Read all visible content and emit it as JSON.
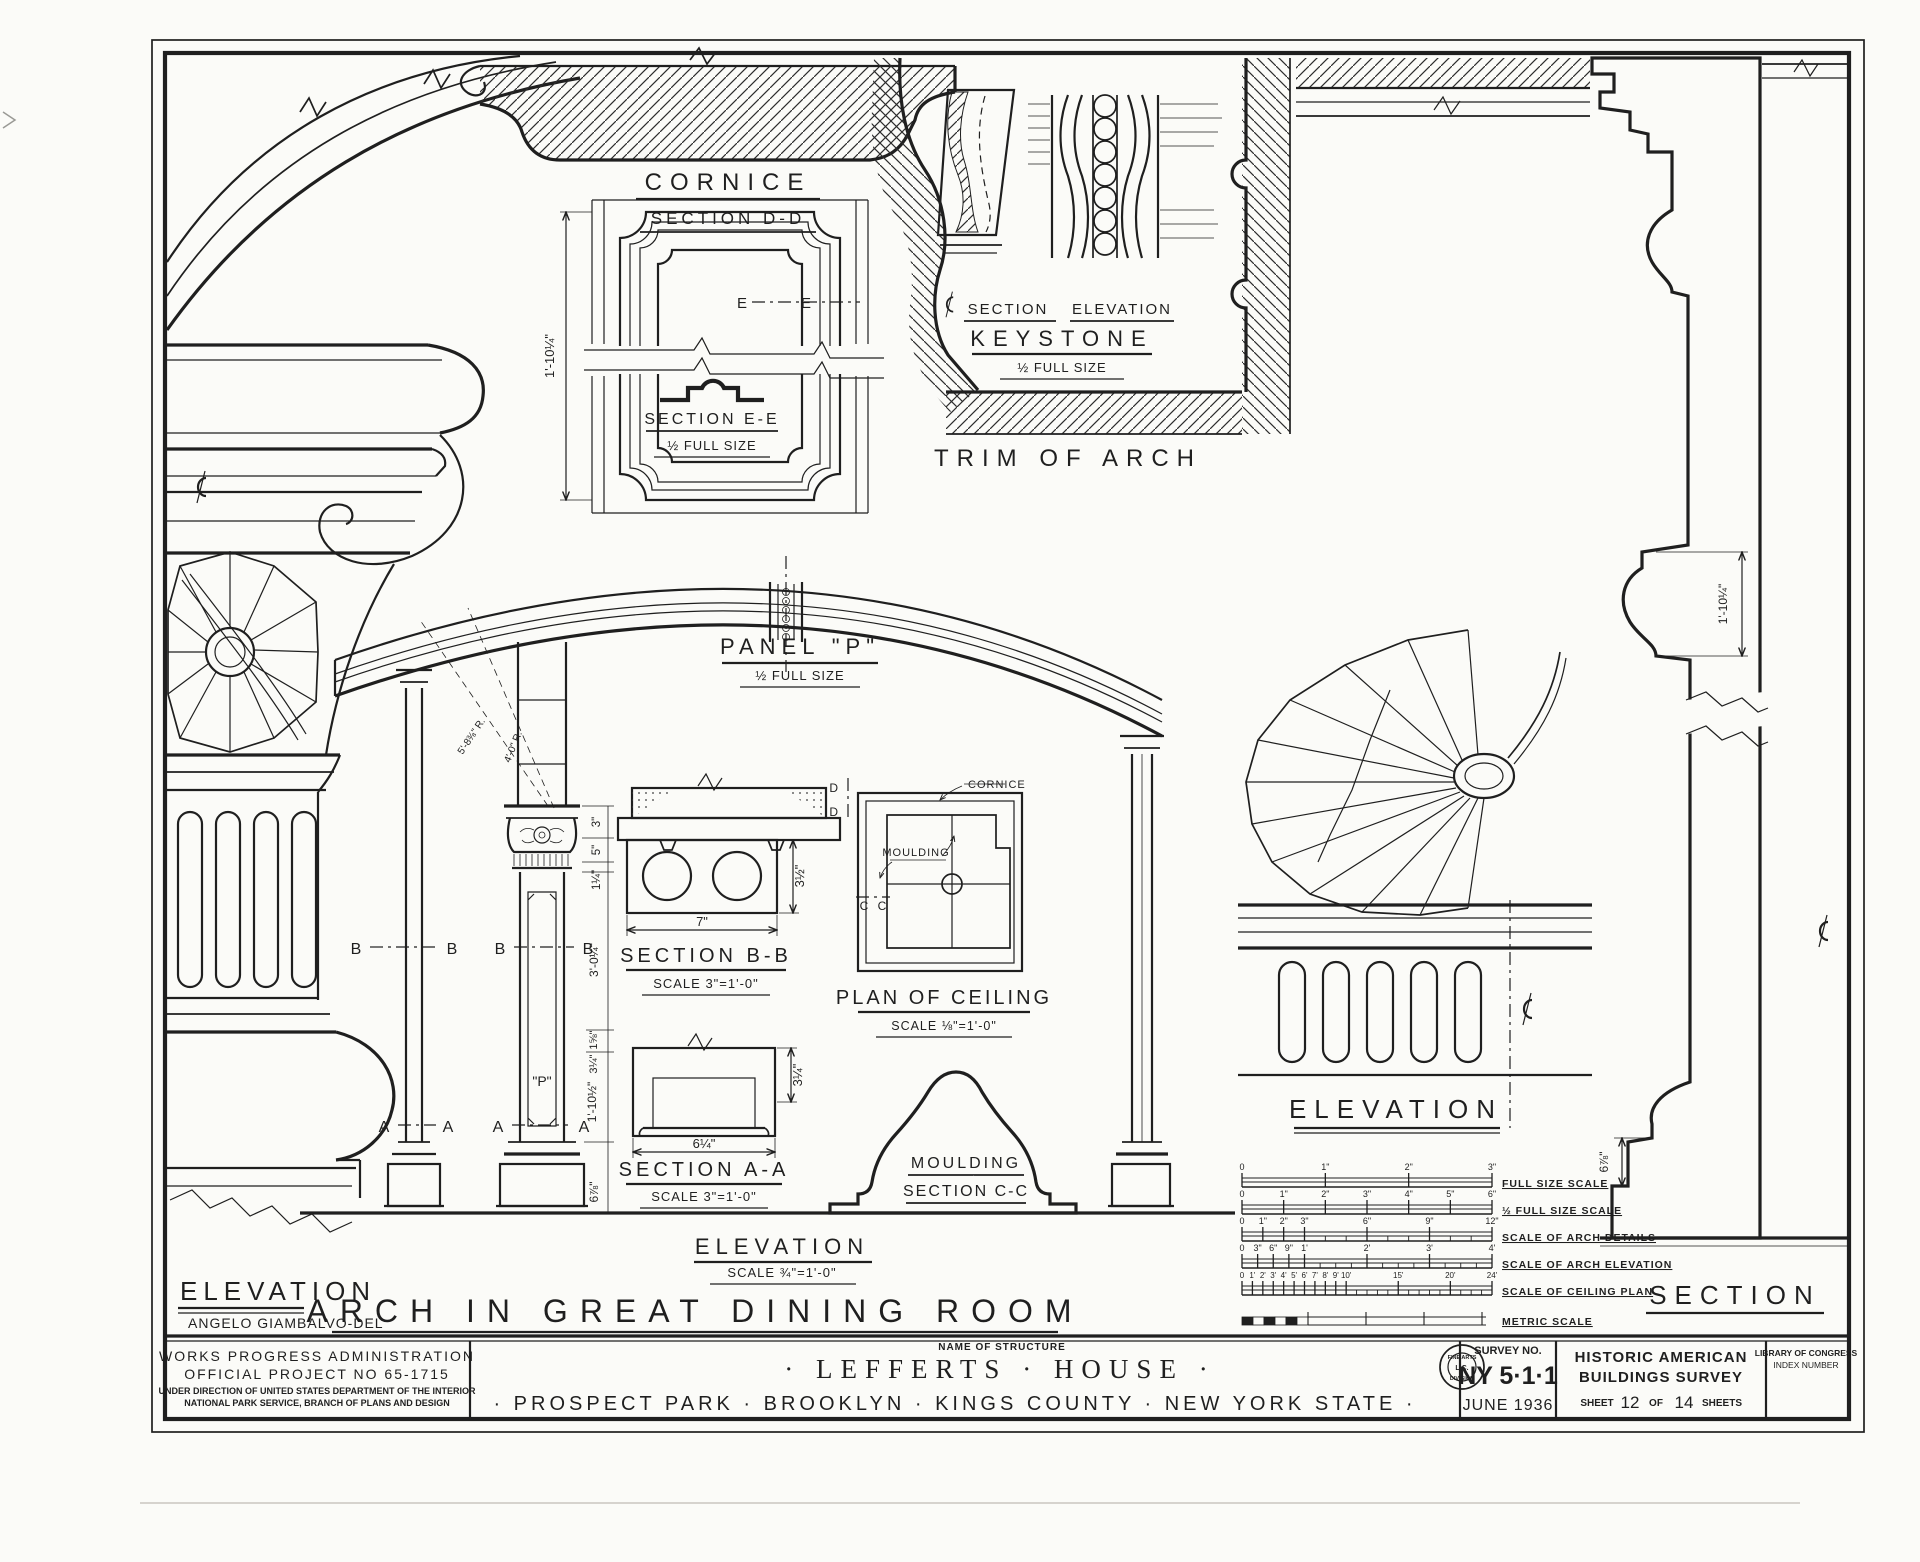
{
  "titles": {
    "main": "ARCH IN GREAT DINING ROOM",
    "delineator": "ANGELO GIAMBALVO-DEL"
  },
  "details": {
    "cornice": {
      "title": "CORNICE",
      "subtitle": "SECTION D-D"
    },
    "panel_p": {
      "height_dim": "1'-10¼\"",
      "marker": "E",
      "section_title": "SECTION E-E",
      "section_scale": "½ FULL SIZE",
      "title": "PANEL \"P\"",
      "scale": "½ FULL SIZE"
    },
    "keystone": {
      "section_label": "SECTION",
      "elevation_label": "ELEVATION",
      "title": "KEYSTONE",
      "scale": "½ FULL SIZE"
    },
    "trim": {
      "title": "TRIM OF ARCH"
    },
    "arch": {
      "marker_a": "A",
      "marker_b": "B",
      "panel_letter": "\"P\"",
      "radius_outer": "5'-8⅜\" R.",
      "radius_inner": "4'-0\" R.",
      "dim_3": "3\"",
      "dim_5": "5\"",
      "dim_1q": "1¼\"",
      "dim_3ft": "3'-0¼\"",
      "dim_1e": "1⅝\"",
      "dim_3q": "3¼\"",
      "dim_shaft": "1'-10½\"",
      "dim_base": "6⅞\"",
      "title": "ELEVATION",
      "scale": "SCALE ¾\"=1'-0\""
    },
    "section_bb": {
      "title": "SECTION B-B",
      "scale": "SCALE 3\"=1'-0\"",
      "width": "7\"",
      "height": "3½\""
    },
    "section_aa": {
      "title": "SECTION A-A",
      "scale": "SCALE 3\"=1'-0\"",
      "width": "6¼\"",
      "height": "3¼\""
    },
    "ceiling": {
      "title": "PLAN OF CEILING",
      "scale": "SCALE ⅛\"=1'-0\"",
      "cornice": "CORNICE",
      "moulding": "MOULDING",
      "marker_c": "C",
      "marker_d": "D"
    },
    "moulding_cc": {
      "title": "MOULDING",
      "subtitle": "SECTION C-C"
    },
    "left_elev": {
      "title": "ELEVATION"
    },
    "right_elev": {
      "title": "ELEVATION"
    },
    "right_sect": {
      "title": "SECTION",
      "dim_top": "1'-10¼\"",
      "dim_bottom": "6⅞\""
    }
  },
  "scale_bars": {
    "bars": [
      {
        "label": "FULL SIZE SCALE",
        "ticks": [
          "0",
          "1\"",
          "2\"",
          "3\""
        ]
      },
      {
        "label": "½ FULL SIZE SCALE",
        "ticks": [
          "0",
          "1\"",
          "2\"",
          "3\"",
          "4\"",
          "5\"",
          "6\""
        ]
      },
      {
        "label": "SCALE OF ARCH DETAILS",
        "ticks": [
          "0",
          "1\"",
          "2\"",
          "3\"",
          "6\"",
          "9\"",
          "12\""
        ]
      },
      {
        "label": "SCALE OF ARCH ELEVATION",
        "ticks": [
          "0",
          "3\"",
          "6\"",
          "9\"",
          "1'",
          "2'",
          "3'",
          "4'"
        ]
      },
      {
        "label": "SCALE OF CEILING PLAN",
        "ticks": [
          "0",
          "1'",
          "2'",
          "3'",
          "4'",
          "5'",
          "6'",
          "7'",
          "8'",
          "9'",
          "10'",
          "15'",
          "20'",
          "24'"
        ]
      },
      {
        "label": "METRIC SCALE",
        "ticks": []
      }
    ]
  },
  "title_block": {
    "org1": "WORKS PROGRESS ADMINISTRATION",
    "org2": "OFFICIAL PROJECT NO 65-1715",
    "org3": "UNDER DIRECTION OF UNITED STATES DEPARTMENT OF THE INTERIOR",
    "org4": "NATIONAL PARK SERVICE, BRANCH OF PLANS AND DESIGN",
    "structure_label": "NAME OF STRUCTURE",
    "structure_name": "· LEFFERTS · HOUSE ·",
    "structure_location": "· PROSPECT PARK · BROOKLYN · KINGS COUNTY · NEW YORK STATE ·",
    "survey_label": "SURVEY NO.",
    "survey_no": "NY 5·1·1",
    "survey_date": "JUNE 1936",
    "habs1": "HISTORIC AMERICAN",
    "habs2": "BUILDINGS SURVEY",
    "sheet_word": "SHEET",
    "sheet_no": "12",
    "of_word": "OF",
    "sheet_total": "14",
    "sheets_word": "SHEETS",
    "loc1": "LIBRARY OF CONGRESS",
    "loc2": "INDEX NUMBER"
  },
  "stamp": {
    "top": "FINE ARTS",
    "mid": "L.C.",
    "bottom": "DIVISION"
  }
}
